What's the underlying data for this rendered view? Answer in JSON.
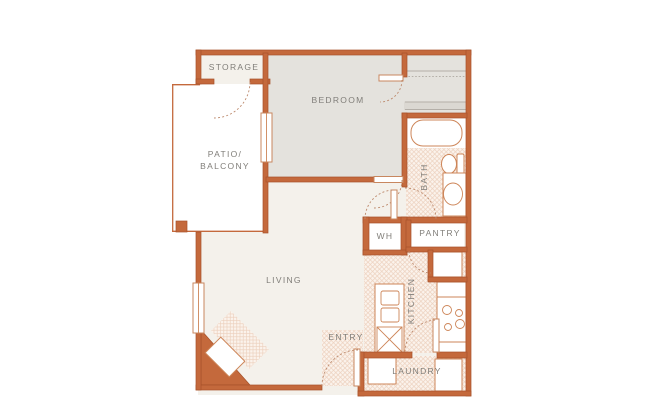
{
  "floor_plan": {
    "rooms": {
      "storage": {
        "label": "STORAGE"
      },
      "patio": {
        "label_line1": "PATIO/",
        "label_line2": "BALCONY"
      },
      "bedroom": {
        "label": "BEDROOM"
      },
      "bath": {
        "label": "BATH"
      },
      "water_heater": {
        "label": "WH"
      },
      "pantry": {
        "label": "PANTRY"
      },
      "living": {
        "label": "LIVING"
      },
      "kitchen": {
        "label": "KITCHEN"
      },
      "entry": {
        "label": "ENTRY"
      },
      "laundry": {
        "label": "LAUNDRY"
      }
    },
    "colors": {
      "wall": "#c4693c",
      "wall_edge": "#a7522a",
      "floor": "#f4f1eb",
      "bedroom_floor": "#e4e2dd",
      "tile_base": "#fbf3ec",
      "tile_hatch": "#ecd0bd",
      "fixture_stroke": "#cd8558",
      "label_text": "#807e79",
      "background": "#ffffff"
    }
  }
}
